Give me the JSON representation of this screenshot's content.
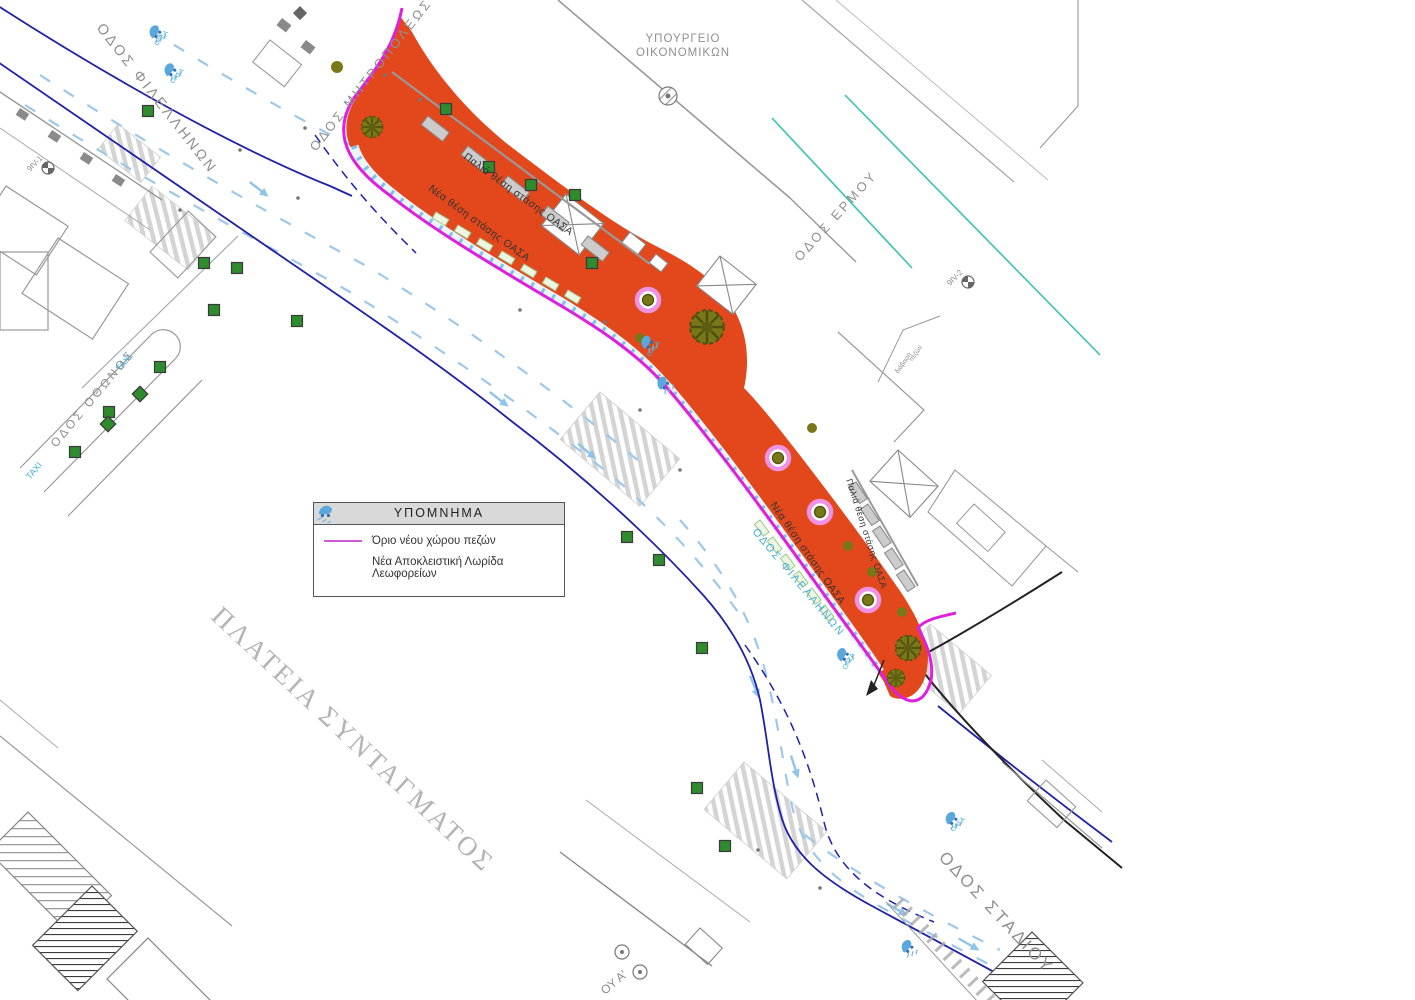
{
  "page": {
    "width": 1415,
    "height": 1000,
    "background": "#ffffff",
    "type": "urban pedestrianization site plan, Syntagma Square, Athens"
  },
  "legend": {
    "title": "ΥΠΟΜΝΗΜΑ",
    "items": [
      {
        "label": "Όριο νέου χώρου πεζών",
        "symbol": "magenta-line",
        "color": "#cf5ccf"
      },
      {
        "label": "Νέα Αποκλειστική Λωρίδα Λεωφορείων",
        "symbol": "bus-lane-icon",
        "color": "#5aa7dc"
      }
    ]
  },
  "labels": {
    "street_filellinon_nw": "ΟΔΟΣ ΦΙΛΕΛΛΗΝΩΝ",
    "street_mitropoleos": "ΟΔΟΣ ΜΗΤΡΟΠΟΛΕΩΣ",
    "ministry_line1": "ΥΠΟΥΡΓΕΙΟ",
    "ministry_line2": "ΟΙΚΟΝΟΜΙΚΩΝ",
    "street_ermou": "ΟΔΟΣ ΕΡΜΟΥ",
    "square": "ΠΛΑΤΕΙΑ ΣΥΝΤΑΓΜΑΤΟΣ",
    "street_stadiou": "ΟΔΟΣ  ΣΤΑΔΙΟΥ",
    "street_othonos": "ΟΔΟΣ ΟΘΩΝΟΣ",
    "street_filellinon_se": "ΟΔΟΣ ΦΙΛΕΛΛΗΝΩΝ",
    "street_georgiou_partial": "ΟΥ Α'",
    "taxi": "TAXI",
    "oasa": "ΟΑΣΑ",
    "new_bus_stop": "Νέα θέση στάσης ΟΑΣΑ",
    "old_bus_stop": "Παλιά θέση στάσης ΟΑΣΑ",
    "crossing_note_1": "διάβαση",
    "crossing_note_2": "πεζών",
    "benchmark_1": "9IV-1",
    "benchmark_2": "9IV-2"
  },
  "colors": {
    "pedestrian_zone": "#e2481c",
    "pedestrian_boundary": "#de1fde",
    "bus_lane_dash": "#86bfe4",
    "lane_marking": "#9dc8ea",
    "curb_navy": "#2020a8",
    "tram_teal": "#39c2b1",
    "tree_ring_pink": "#f092e2",
    "tree_olive": "#787819",
    "tree_green": "#2e8b2e",
    "building_gray": "#8f8f8f"
  }
}
